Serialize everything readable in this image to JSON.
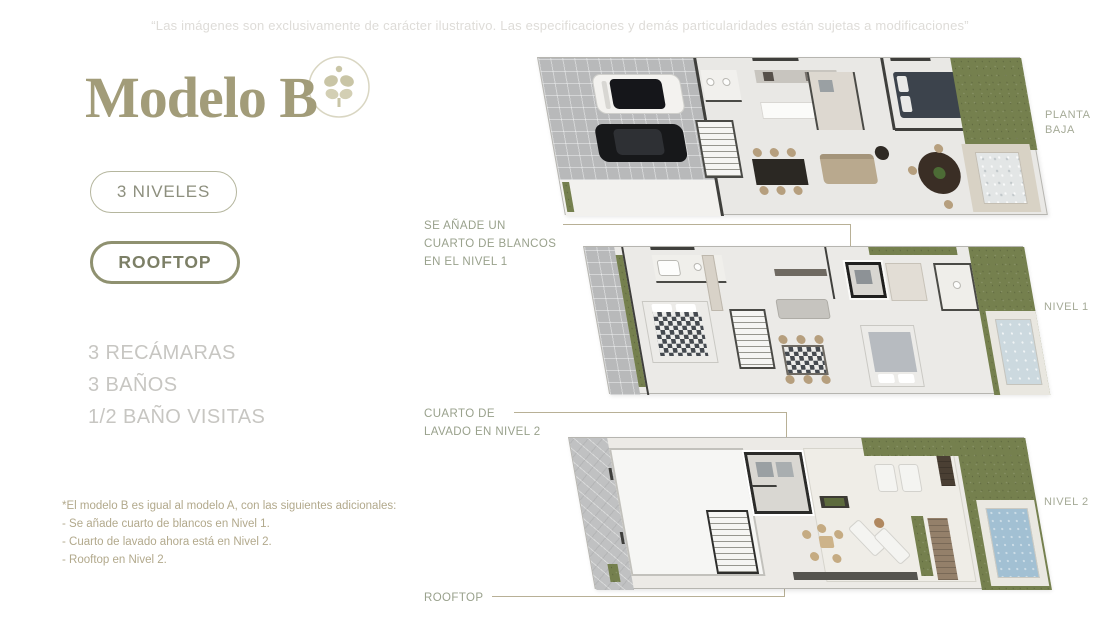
{
  "disclaimer": "“Las imágenes son exclusivamente de carácter ilustrativo. Las especificaciones y demás particularidades están sujetas a modificaciones”",
  "brand": {
    "model_title": "Modelo B"
  },
  "badges": {
    "levels": "3 NIVELES",
    "rooftop": "ROOFTOP"
  },
  "features": [
    "3 RECÁMARAS",
    "3 BAÑOS",
    "1/2 BAÑO VISITAS"
  ],
  "footnote": {
    "title": "*El modelo B es igual al modelo A, con las siguientes adicionales:",
    "items": [
      "- Se añade cuarto de blancos en Nivel 1.",
      "- Cuarto de lavado ahora está en Nivel 2.",
      "- Rooftop en Nivel 2."
    ]
  },
  "annotations": {
    "blancos": "SE AÑADE UN\nCUARTO DE BLANCOS\nEN EL NIVEL 1",
    "lavado": "CUARTO DE\nLAVADO EN NIVEL 2",
    "rooftop": "ROOFTOP"
  },
  "floor_labels": {
    "planta_baja": "PLANTA\nBAJA",
    "nivel_1": "NIVEL 1",
    "nivel_2": "NIVEL 2"
  },
  "colors": {
    "accent_olive": "#a29c79",
    "badge_border": "#8f9170",
    "feature_gray": "#c7c6c2",
    "annotation_green": "#99a18c",
    "pointer_tan": "#b8b096",
    "grass_green": "#75804e",
    "pool_blue": "#a2c0d3"
  }
}
